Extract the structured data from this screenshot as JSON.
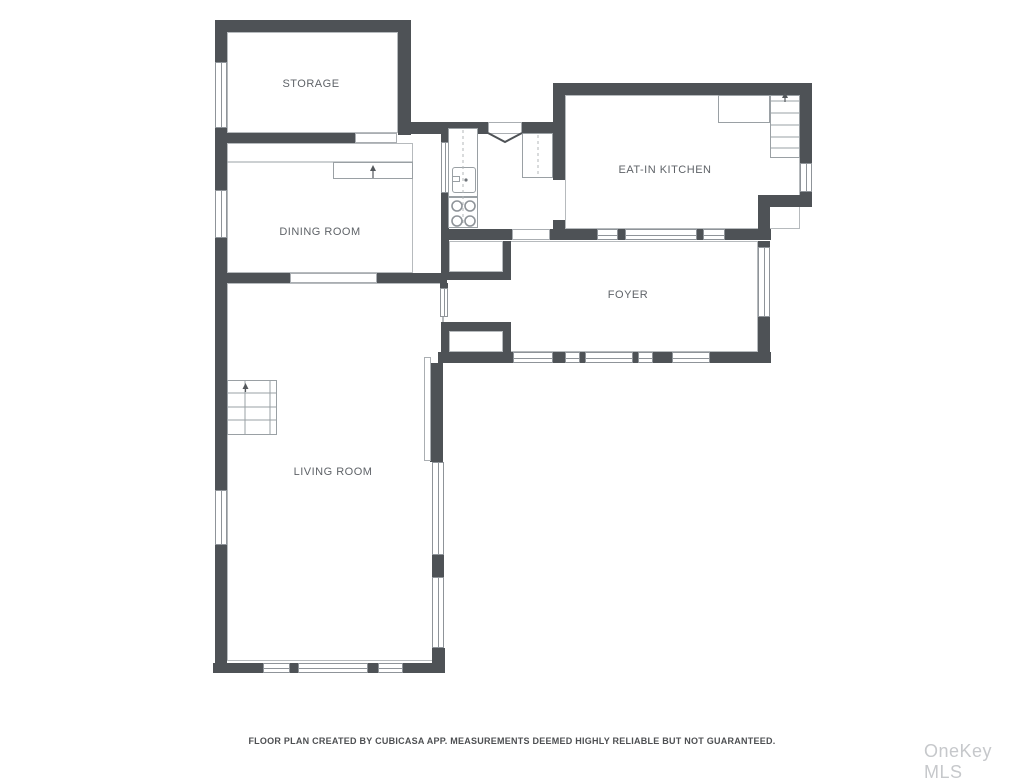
{
  "page": {
    "width": 1024,
    "height": 768,
    "background": "#ffffff"
  },
  "colors": {
    "wall": "#4e5256",
    "window_frame": "#8f9499",
    "room_outline": "#b6babd",
    "fixture_line": "#9aa0a4",
    "label_text": "#5f6368",
    "watermark_text": "#c6c8cb"
  },
  "rooms": [
    {
      "id": "storage",
      "label": "STORAGE",
      "rect": [
        227,
        32,
        171,
        101
      ],
      "label_x": 311,
      "label_y": 84
    },
    {
      "id": "dining-room",
      "label": "DINING ROOM",
      "rect": [
        227,
        143,
        186,
        130
      ],
      "label_x": 320,
      "label_y": 232
    },
    {
      "id": "eat-in-kitchen",
      "label": "EAT-IN KITCHEN",
      "rect": [
        565,
        95,
        235,
        134
      ],
      "label_x": 665,
      "label_y": 170
    },
    {
      "id": "foyer",
      "label": "FOYER",
      "rect": [
        443,
        241,
        315,
        111
      ],
      "label_x": 628,
      "label_y": 295
    },
    {
      "id": "living-room",
      "label": "LIVING ROOM",
      "rect": [
        227,
        283,
        216,
        378
      ],
      "label_x": 333,
      "label_y": 472
    },
    {
      "id": "closet-1",
      "label": "",
      "rect": [
        449,
        241,
        54,
        31
      ],
      "label_x": 0,
      "label_y": 0
    },
    {
      "id": "closet-2",
      "label": "",
      "rect": [
        449,
        331,
        54,
        21
      ],
      "label_x": 0,
      "label_y": 0
    }
  ],
  "walls": [
    [
      215,
      20,
      196,
      12
    ],
    [
      215,
      20,
      12,
      42
    ],
    [
      215,
      128,
      12,
      62
    ],
    [
      215,
      238,
      12,
      252
    ],
    [
      215,
      545,
      12,
      128
    ],
    [
      398,
      20,
      13,
      115
    ],
    [
      215,
      133,
      140,
      10
    ],
    [
      398,
      122,
      92,
      12
    ],
    [
      522,
      122,
      33,
      12
    ],
    [
      553,
      83,
      259,
      12
    ],
    [
      553,
      95,
      12,
      85
    ],
    [
      800,
      95,
      12,
      68
    ],
    [
      800,
      192,
      12,
      15
    ],
    [
      758,
      195,
      54,
      12
    ],
    [
      758,
      207,
      12,
      24
    ],
    [
      441,
      229,
      71,
      11
    ],
    [
      550,
      229,
      47,
      11
    ],
    [
      618,
      229,
      7,
      11
    ],
    [
      697,
      229,
      6,
      11
    ],
    [
      725,
      229,
      46,
      11
    ],
    [
      553,
      220,
      12,
      9
    ],
    [
      758,
      241,
      12,
      6
    ],
    [
      758,
      317,
      12,
      46
    ],
    [
      438,
      352,
      75,
      11
    ],
    [
      553,
      352,
      12,
      11
    ],
    [
      580,
      352,
      5,
      11
    ],
    [
      633,
      352,
      5,
      11
    ],
    [
      653,
      352,
      19,
      11
    ],
    [
      710,
      352,
      61,
      11
    ],
    [
      441,
      128,
      8,
      14
    ],
    [
      441,
      193,
      8,
      87
    ],
    [
      503,
      241,
      8,
      31
    ],
    [
      441,
      272,
      70,
      8
    ],
    [
      440,
      283,
      8,
      5
    ],
    [
      441,
      322,
      70,
      9
    ],
    [
      441,
      331,
      8,
      32
    ],
    [
      503,
      331,
      8,
      21
    ],
    [
      215,
      273,
      75,
      10
    ],
    [
      377,
      273,
      70,
      10
    ],
    [
      430,
      363,
      13,
      99
    ],
    [
      432,
      555,
      12,
      22
    ],
    [
      432,
      648,
      13,
      25
    ],
    [
      213,
      663,
      50,
      10
    ],
    [
      290,
      663,
      8,
      10
    ],
    [
      368,
      663,
      10,
      10
    ],
    [
      403,
      663,
      42,
      10
    ]
  ],
  "windows": [
    [
      215,
      62,
      12,
      66
    ],
    [
      215,
      190,
      12,
      48
    ],
    [
      215,
      490,
      12,
      55
    ],
    [
      263,
      663,
      27,
      10
    ],
    [
      298,
      663,
      70,
      10
    ],
    [
      378,
      663,
      25,
      10
    ],
    [
      432,
      462,
      12,
      93
    ],
    [
      432,
      577,
      12,
      71
    ],
    [
      440,
      288,
      8,
      29
    ],
    [
      441,
      142,
      8,
      51
    ],
    [
      597,
      229,
      21,
      11
    ],
    [
      625,
      229,
      72,
      11
    ],
    [
      703,
      229,
      22,
      11
    ],
    [
      758,
      247,
      12,
      70
    ],
    [
      800,
      163,
      12,
      29
    ],
    [
      513,
      352,
      40,
      11
    ],
    [
      565,
      352,
      15,
      11
    ],
    [
      585,
      352,
      48,
      11
    ],
    [
      638,
      352,
      15,
      11
    ],
    [
      672,
      352,
      38,
      11
    ]
  ],
  "openings": [
    [
      355,
      133,
      42,
      10
    ],
    [
      290,
      273,
      87,
      10
    ],
    [
      512,
      229,
      38,
      11
    ],
    [
      488,
      122,
      34,
      12
    ],
    [
      424,
      357,
      7,
      104
    ]
  ],
  "fixtures": [
    {
      "name": "kitchen-counter",
      "cls": "",
      "rect": [
        448,
        128,
        30,
        69
      ]
    },
    {
      "name": "kitchen-sink",
      "cls": "rounded",
      "rect": [
        452,
        167,
        24,
        26
      ]
    },
    {
      "name": "sink-faucet",
      "cls": "",
      "rect": [
        452,
        176,
        8,
        6
      ]
    },
    {
      "name": "stove",
      "cls": "",
      "rect": [
        448,
        197,
        30,
        31
      ]
    },
    {
      "name": "kitchen-counter-2",
      "cls": "",
      "rect": [
        522,
        133,
        31,
        45
      ]
    },
    {
      "name": "stair-landing",
      "cls": "",
      "rect": [
        718,
        95,
        52,
        28
      ]
    },
    {
      "name": "stairs-kitchen",
      "cls": "",
      "rect": [
        770,
        95,
        30,
        63
      ]
    },
    {
      "name": "stairs-living",
      "cls": "",
      "rect": [
        227,
        380,
        50,
        55
      ]
    },
    {
      "name": "dining-step",
      "cls": "",
      "rect": [
        333,
        162,
        80,
        17
      ]
    }
  ],
  "svg": {
    "lines": [
      [
        227,
        162,
        413,
        162
      ],
      [
        227,
        393,
        277,
        393
      ],
      [
        227,
        407,
        277,
        407
      ],
      [
        227,
        420,
        277,
        420
      ],
      [
        245,
        380,
        245,
        435
      ],
      [
        270,
        380,
        270,
        435
      ],
      [
        770,
        101,
        800,
        101
      ],
      [
        770,
        113,
        800,
        113
      ],
      [
        770,
        125,
        800,
        125
      ],
      [
        770,
        137,
        800,
        137
      ],
      [
        770,
        148,
        800,
        148
      ]
    ],
    "dashed": [
      [
        463,
        130,
        463,
        226
      ],
      [
        538,
        135,
        538,
        176
      ]
    ],
    "circles": [
      [
        457,
        206,
        5
      ],
      [
        470,
        206,
        5
      ],
      [
        457,
        221,
        5
      ],
      [
        470,
        221,
        5
      ]
    ],
    "dots": [
      [
        466,
        180,
        1.6
      ]
    ],
    "arrows": [
      {
        "x": 373,
        "y_tail": 178,
        "y_tip": 165
      },
      {
        "x": 245.5,
        "y_tail": 392,
        "y_tip": 383
      },
      {
        "x": 785,
        "y_tail": 102,
        "y_tip": 92
      }
    ],
    "chevron": [
      [
        488,
        133
      ],
      [
        505,
        142
      ],
      [
        522,
        133
      ]
    ]
  },
  "footer": {
    "disclaimer": "FLOOR PLAN CREATED BY CUBICASA APP. MEASUREMENTS DEEMED HIGHLY RELIABLE BUT NOT GUARANTEED."
  },
  "watermark": {
    "text": "OneKey MLS"
  }
}
